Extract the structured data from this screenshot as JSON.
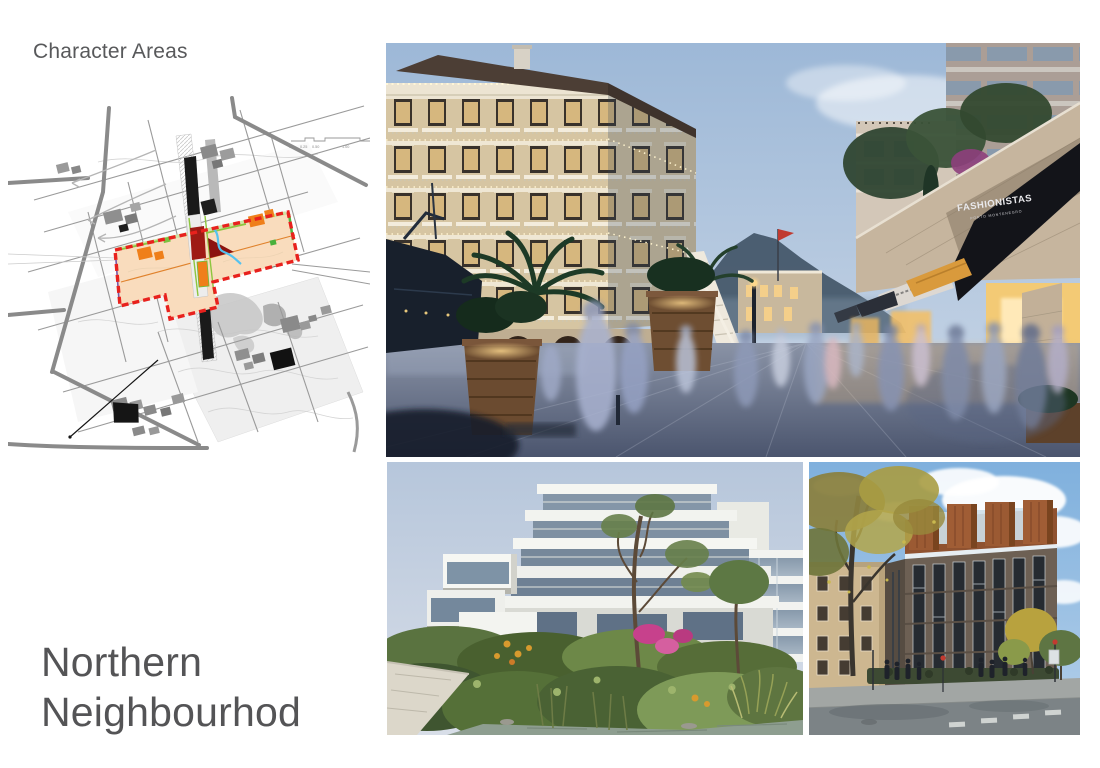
{
  "header": {
    "title": "Character Areas"
  },
  "footer": {
    "title_line1": "Northern",
    "title_line2": "Neighbourhod"
  },
  "map": {
    "scale_labels": [
      "0.0",
      "0.25",
      "0.50",
      "1.00"
    ],
    "colors": {
      "boundary_red": "#e8211d",
      "area_peach": "#f9dcbd",
      "accent_orange": "#ef7f1a",
      "accent_green": "#8dc63f",
      "accent_blue": "#55c2ef",
      "accent_dark_red": "#9e1b15"
    }
  },
  "photos": {
    "main_awning": {
      "line1": "FASHIONISTAS",
      "line2": "PORTO MONTENEGRO"
    }
  }
}
